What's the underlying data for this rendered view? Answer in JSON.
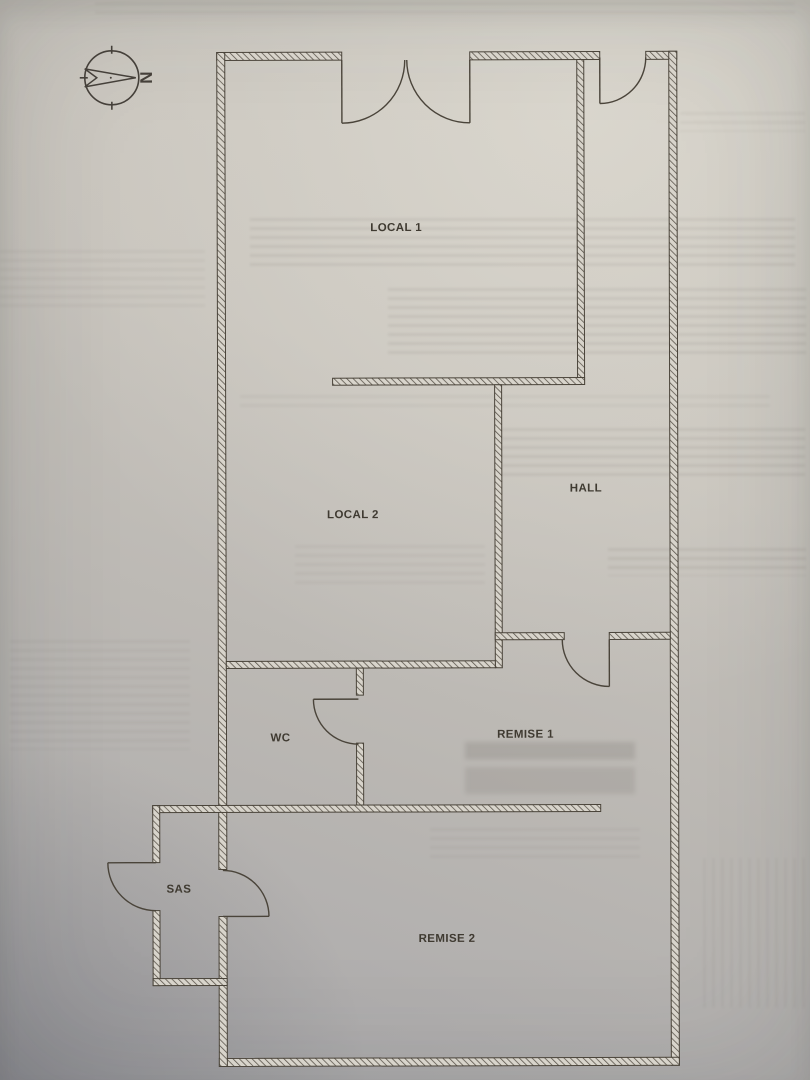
{
  "compass": {
    "north_label": "N"
  },
  "rooms": [
    {
      "id": "local-1",
      "label": "LOCAL 1"
    },
    {
      "id": "local-2",
      "label": "LOCAL 2"
    },
    {
      "id": "hall",
      "label": "HALL"
    },
    {
      "id": "wc",
      "label": "WC"
    },
    {
      "id": "remise-1",
      "label": "REMISE 1"
    },
    {
      "id": "sas",
      "label": "SAS"
    },
    {
      "id": "remise-2",
      "label": "REMISE 2"
    }
  ],
  "colors": {
    "ink": "#4a443a",
    "label_ink": "#3f3a31",
    "wall_fill": "#d8d4cb",
    "paper_top": "#cbc7bf",
    "paper_bottom": "#a8a7aa"
  }
}
